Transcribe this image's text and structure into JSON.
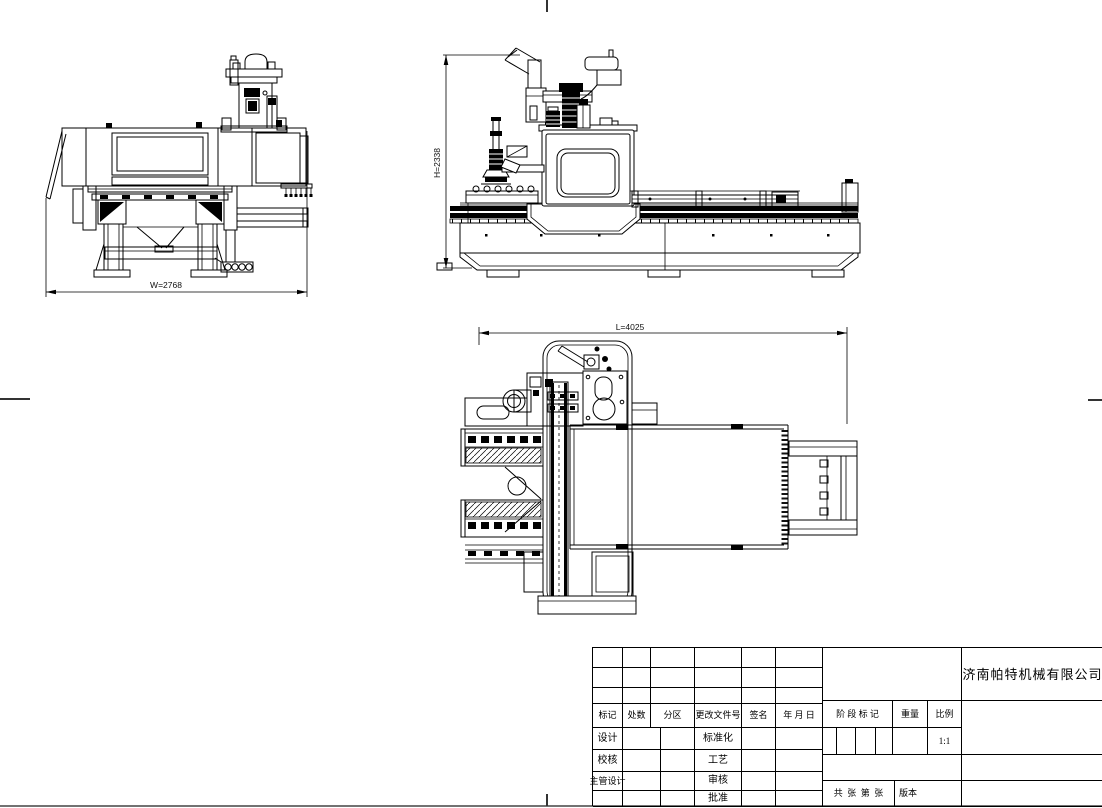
{
  "drawing": {
    "front_view": {
      "dim_width": "W=2768"
    },
    "side_view": {
      "dim_height": "H=2338"
    },
    "top_view": {
      "dim_length": "L=4025"
    }
  },
  "title_block": {
    "company": "济南帕特机械有限公司",
    "header_cols": [
      "标记",
      "处数",
      "分区",
      "更改文件号",
      "签名",
      "年 月 日"
    ],
    "rows": [
      {
        "left": "设计",
        "mid": "标准化"
      },
      {
        "left": "校核",
        "mid": "工艺"
      },
      {
        "left": "主管设计",
        "mid": "审核"
      },
      {
        "left": "",
        "mid": "批准"
      }
    ],
    "stage_mark": "阶 段 标 记",
    "weight": "重量",
    "scale": "比例",
    "scale_value": "1:1",
    "sheets": "共  张  第  张",
    "version": "版本"
  }
}
